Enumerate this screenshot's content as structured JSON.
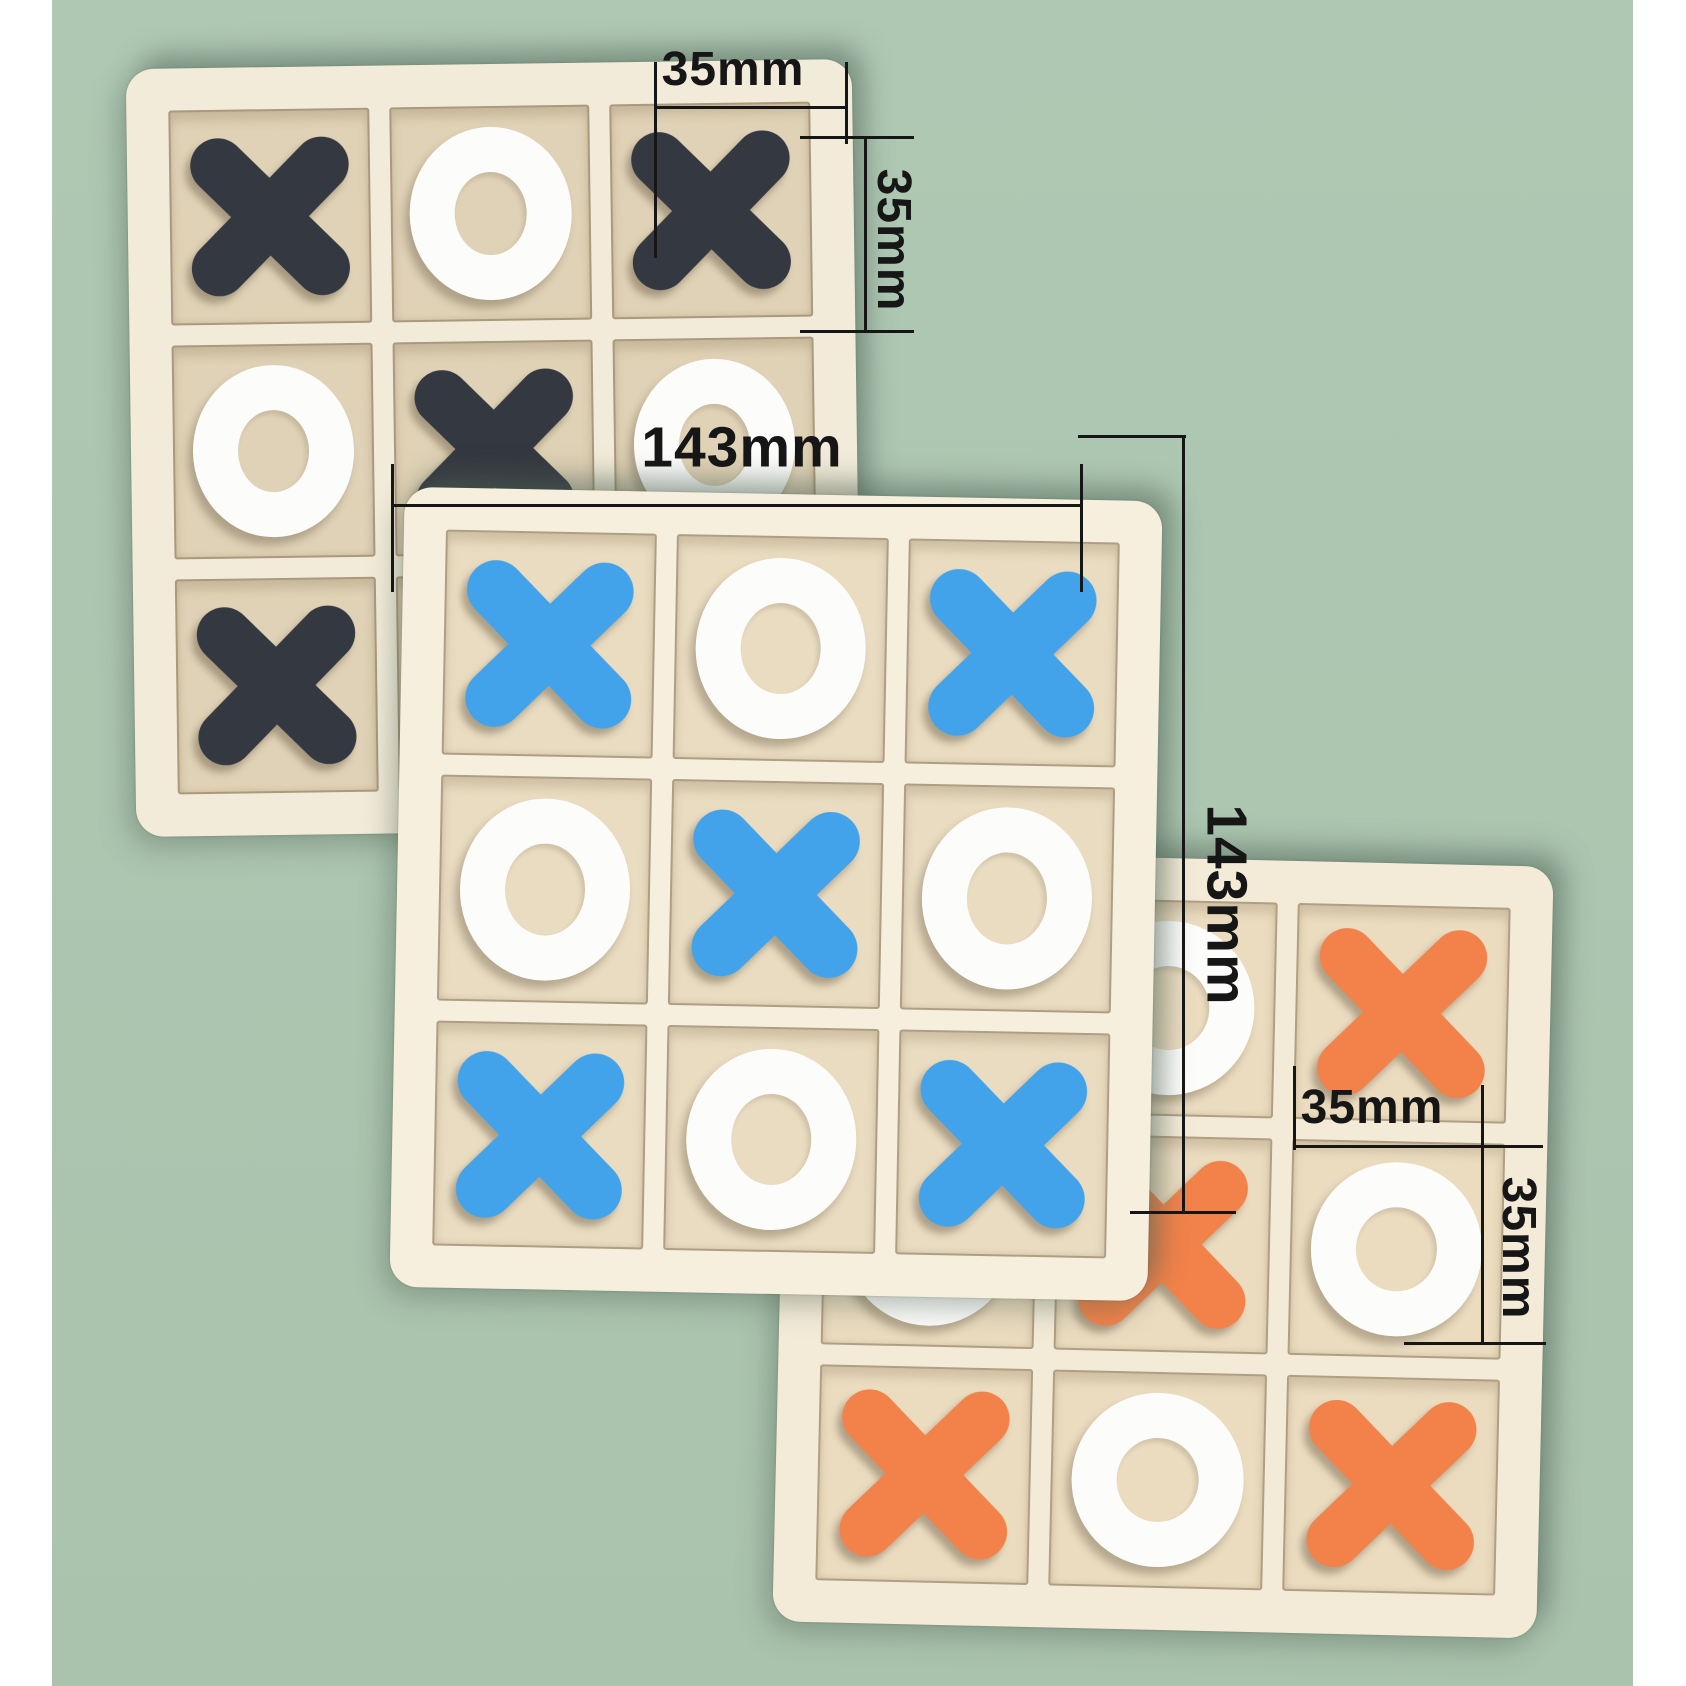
{
  "scene": {
    "backdrop_color": "#aec8b3",
    "backdrop_color_bottom": "#a9c3ad",
    "side_strip_color": "#ffffff",
    "annotation_color": "#161616"
  },
  "boards": [
    {
      "name": "dark-navy-tictactoe-board",
      "frame_color": "#f2ebd9",
      "cell_color": "#e0d2b6",
      "piece_x_color": "#343840",
      "piece_o_color": "#fcfcfb",
      "grid": [
        [
          "X",
          "O",
          "X"
        ],
        [
          "O",
          "X",
          "O"
        ],
        [
          "X",
          "O",
          "X"
        ]
      ]
    },
    {
      "name": "blue-tictactoe-board",
      "frame_color": "#f6efde",
      "cell_color": "#e9dcc1",
      "piece_x_color": "#42a3ea",
      "piece_o_color": "#fcfcfb",
      "grid": [
        [
          "X",
          "O",
          "X"
        ],
        [
          "O",
          "X",
          "O"
        ],
        [
          "X",
          "O",
          "X"
        ]
      ]
    },
    {
      "name": "orange-tictactoe-board",
      "frame_color": "#f3ebd7",
      "cell_color": "#ebdcc0",
      "piece_x_color": "#f2824a",
      "piece_o_color": "#fcfcfb",
      "grid": [
        [
          "X",
          "O",
          "X"
        ],
        [
          "O",
          "X",
          "O"
        ],
        [
          "X",
          "O",
          "X"
        ]
      ]
    }
  ],
  "annotations": {
    "top_cell_width": "35mm",
    "top_cell_height": "35mm",
    "board_width": "143mm",
    "board_height": "143mm",
    "bottom_cell_width": "35mm",
    "bottom_cell_height": "35mm"
  }
}
